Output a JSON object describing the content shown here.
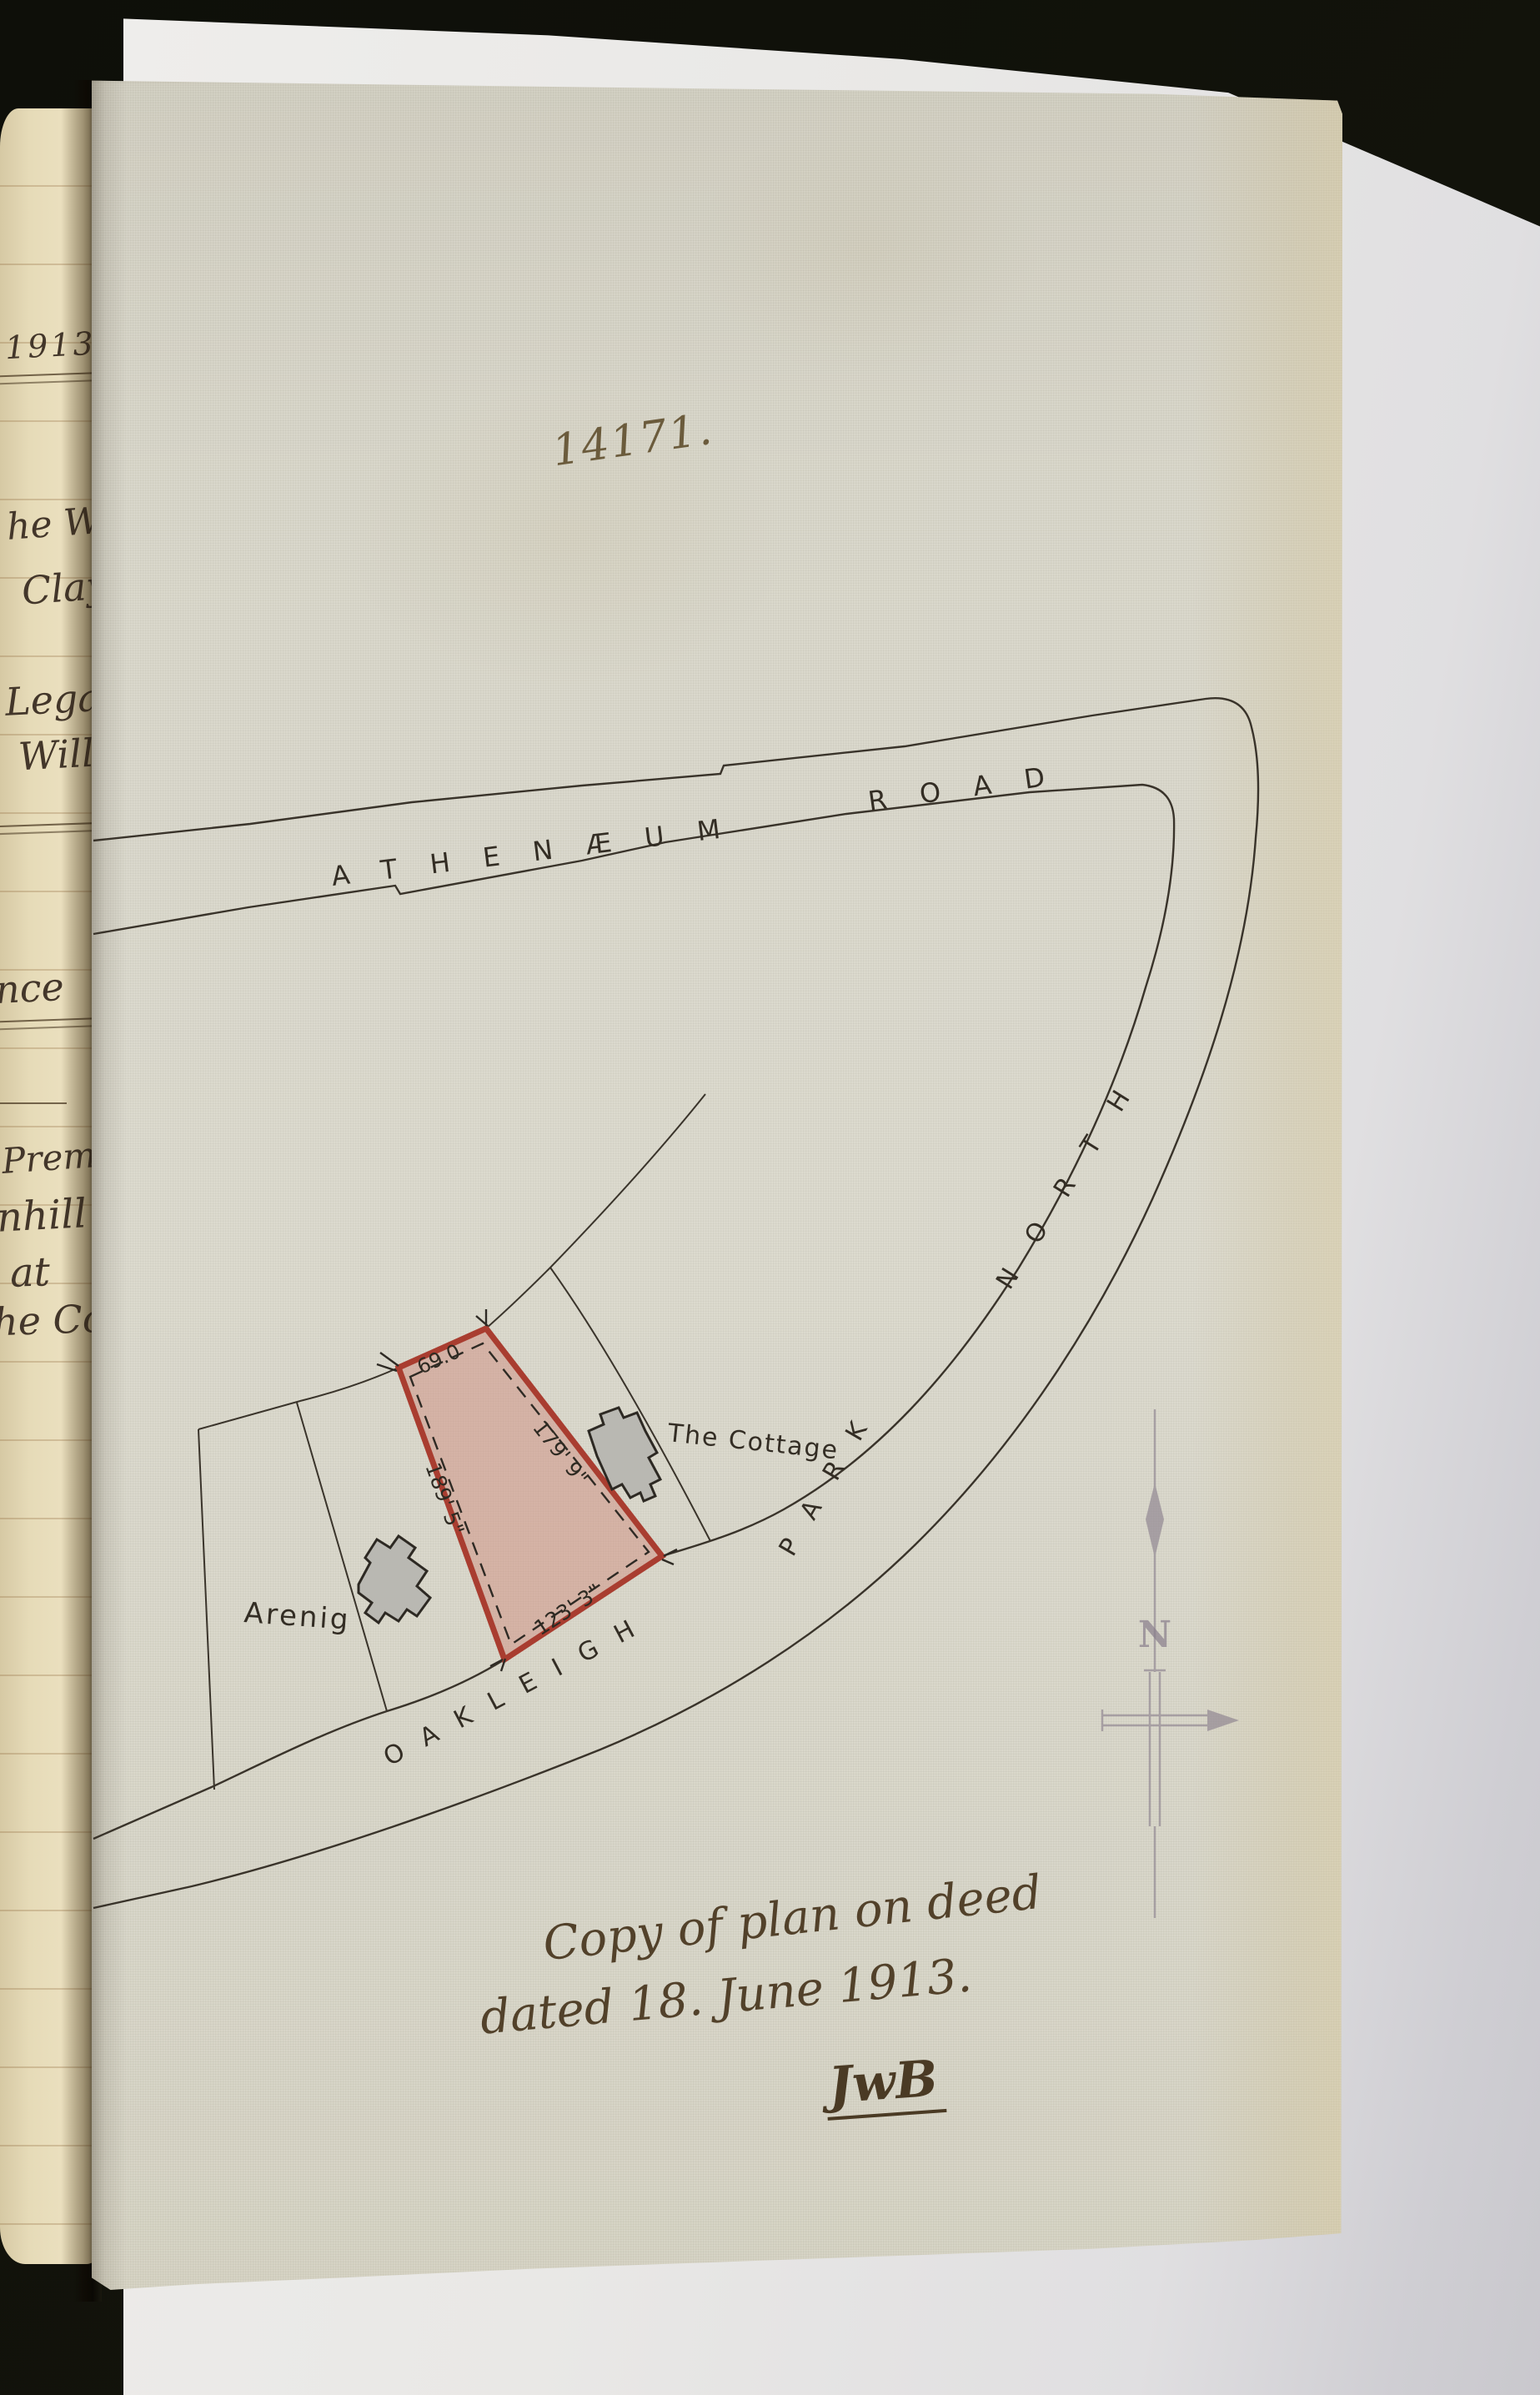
{
  "document": {
    "plan_number": "14171.",
    "note": {
      "line1": "Copy of plan on deed",
      "line2": "dated 18. June 1913.",
      "initials": "JwB"
    }
  },
  "map": {
    "roads": {
      "athenaeum": "ATHENÆUM",
      "athenaeum2": "ROAD",
      "oakleigh": "OAKLEIGH",
      "park": "PARK",
      "north": "NORTH"
    },
    "plot": {
      "dim_top": "69.0",
      "dim_right": "179' 9\"",
      "dim_left": "189' 5\"",
      "dim_bottom": "123' 3\""
    },
    "properties": {
      "cottage": "The Cottage",
      "arenig": "Arenig"
    },
    "compass": {
      "letter": "N"
    },
    "colors": {
      "plot_fill": "#cf8d80",
      "plot_border": "#a93d30",
      "map_ink": "#39332a",
      "compass_ink": "#897e8c"
    }
  },
  "ledger_margin": {
    "lines": [
      "1913.",
      "he Wil",
      "Clay",
      "Legatee",
      "Will",
      "nce",
      "Premise",
      "nhill",
      "at",
      "he Coun"
    ]
  }
}
